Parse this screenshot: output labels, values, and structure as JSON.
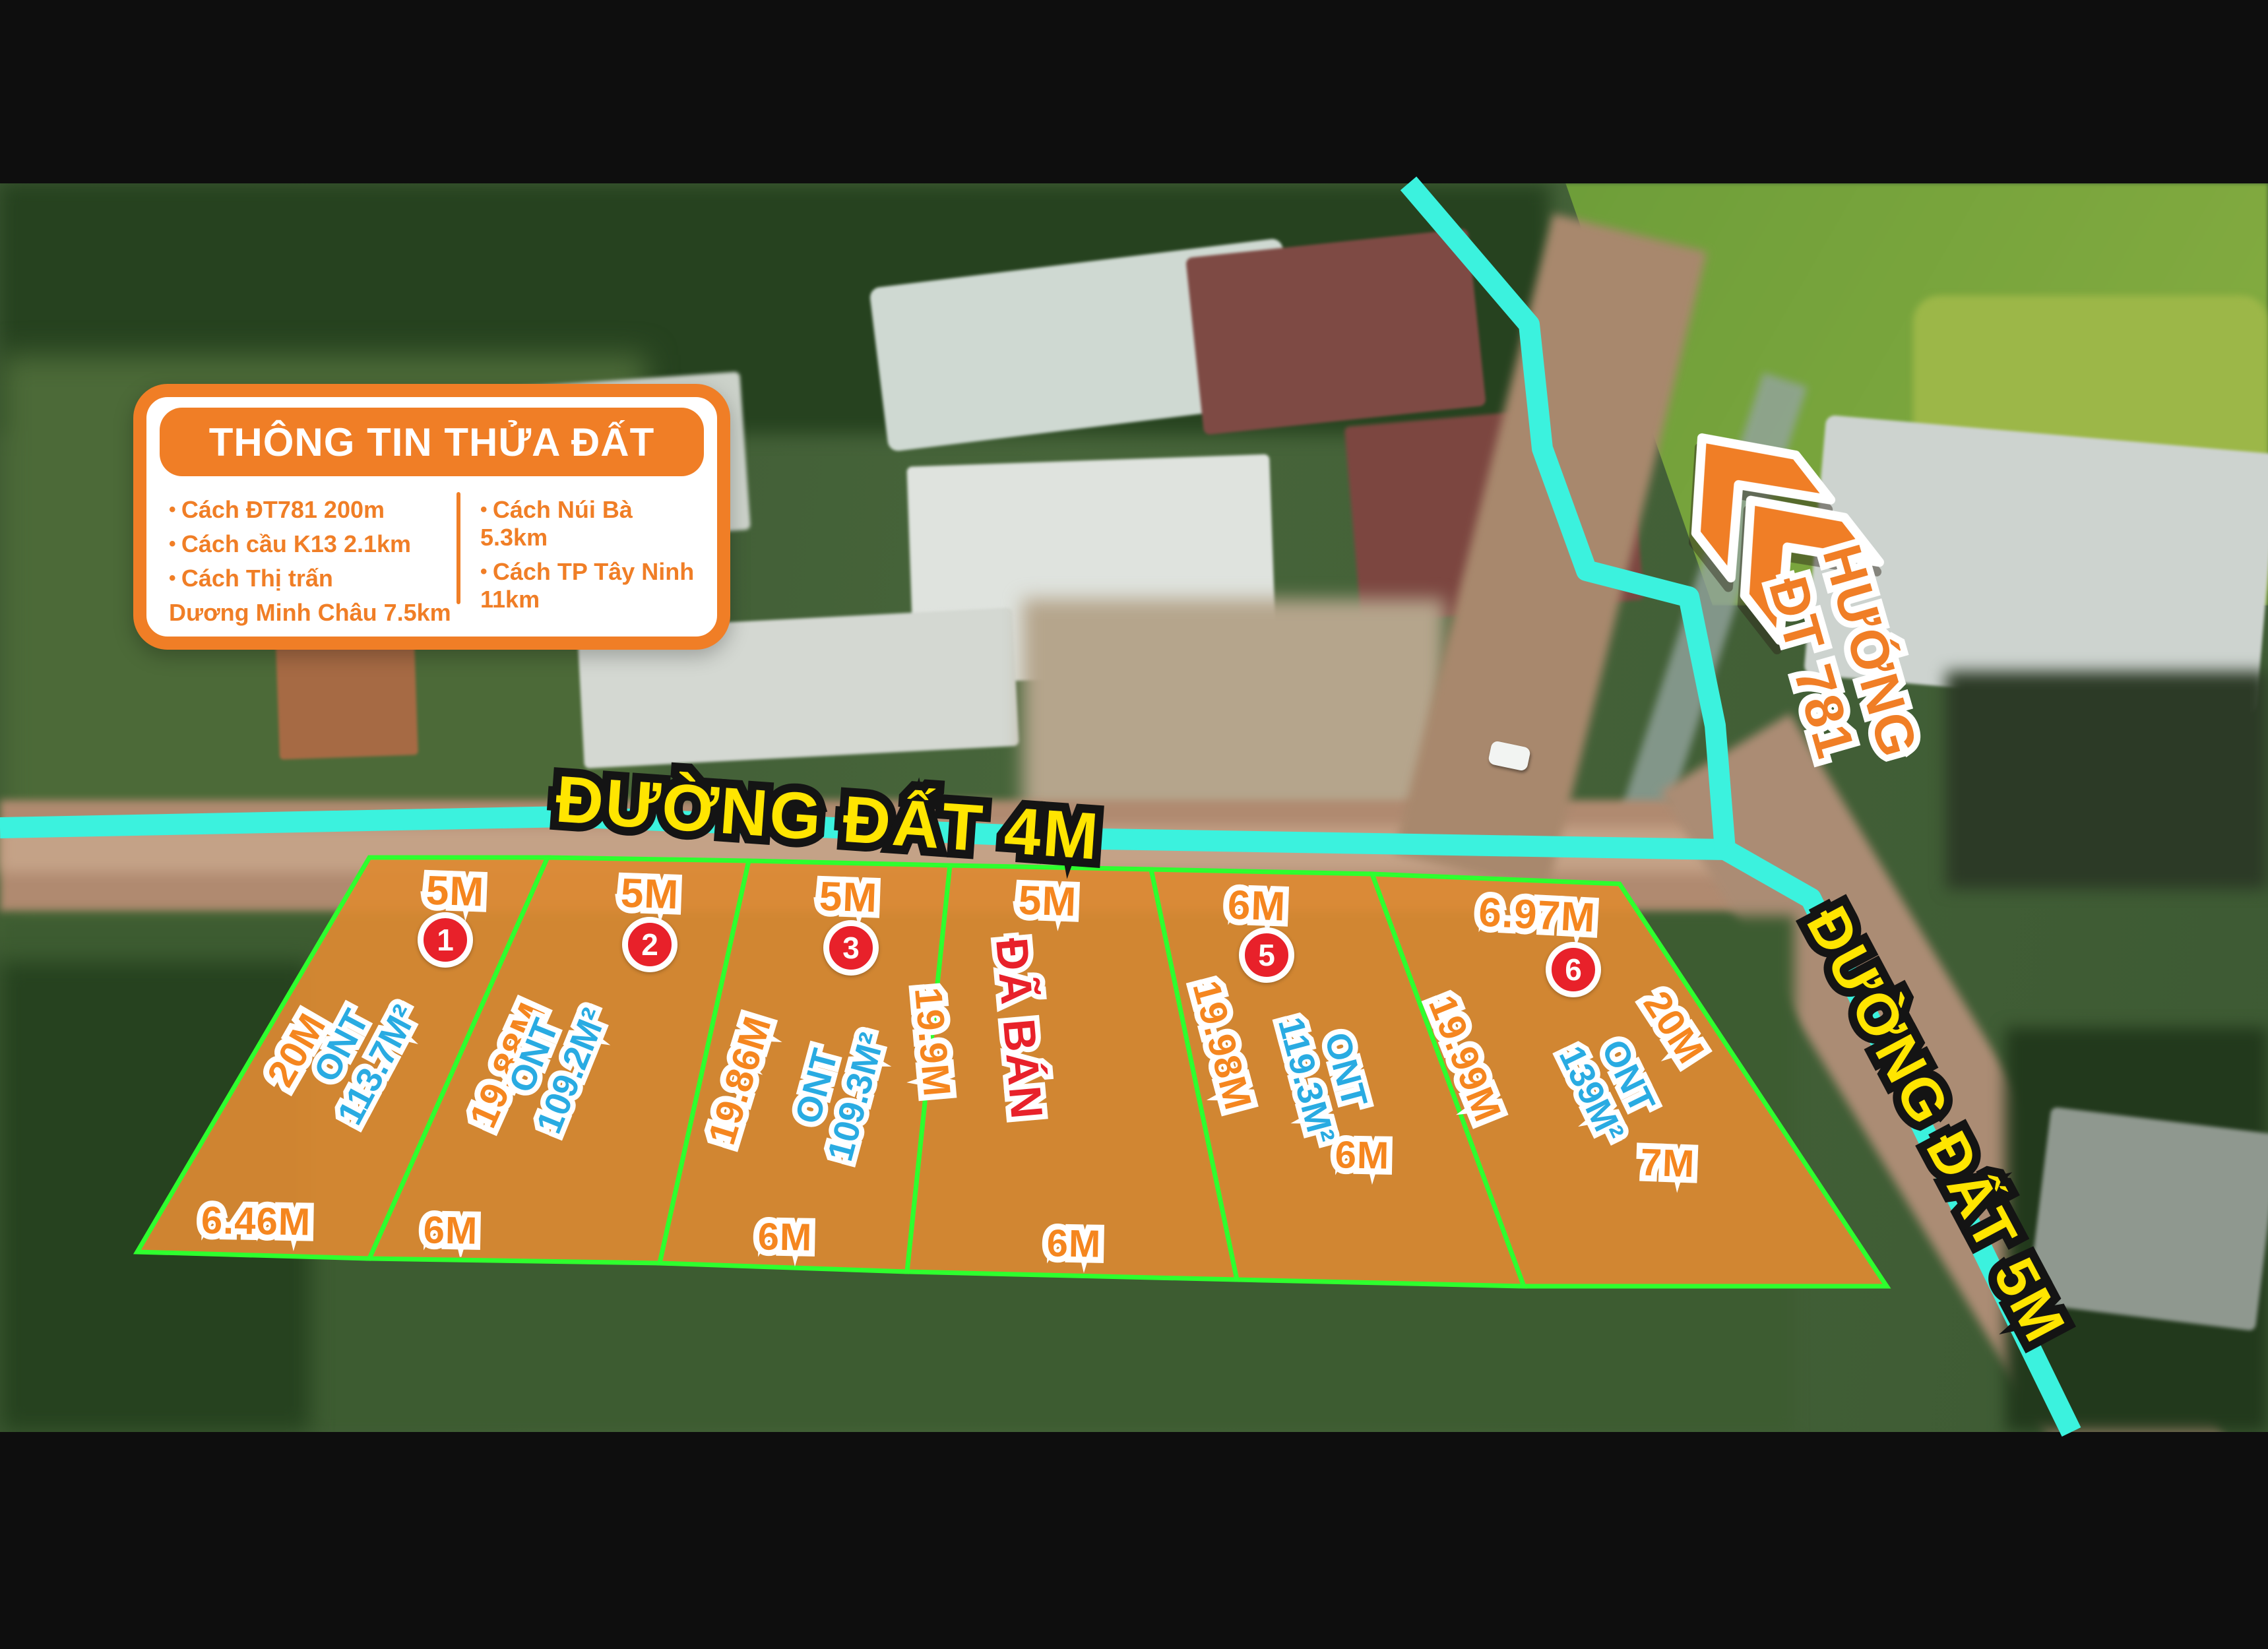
{
  "info_card": {
    "title": "THÔNG TIN THỬA ĐẤT",
    "bullets_left": [
      "Cách ĐT781 200m",
      "Cách cầu K13 2.1km",
      "Cách Thị trấn"
    ],
    "bullets_left_cont": "Dương Minh Châu 7.5km",
    "bullets_right": [
      "Cách Núi Bà 5.3km",
      "Cách TP Tây Ninh 11km"
    ]
  },
  "roads": {
    "top_road_label": "ĐƯỜNG ĐẤT 4M",
    "right_road_label": "ĐƯỜNG ĐẤT 5M",
    "direction_line1": "HƯỚNG",
    "direction_line2": "ĐT 781"
  },
  "plots": [
    {
      "number": "1",
      "top": "5M",
      "bottom": "6.46M",
      "side": "20M",
      "zoning": "ONT",
      "area": "113.7M²",
      "sold": false
    },
    {
      "number": "2",
      "top": "5M",
      "bottom": "6M",
      "side": "19.88M",
      "zoning": "ONT",
      "area": "109.2M²",
      "sold": false
    },
    {
      "number": "3",
      "top": "5M",
      "bottom": "6M",
      "side": "19.86M",
      "zoning": "ONT",
      "area": "109.3M²",
      "sold": false
    },
    {
      "number": "4",
      "top": "5M",
      "bottom": "6M",
      "side": "19.9M",
      "sold_label": "ĐÃ BÁN",
      "sold": true
    },
    {
      "number": "5",
      "top": "6M",
      "bottom": "6M",
      "side": "19.98M",
      "zoning": "ONT",
      "area": "119.3M²",
      "sold": false
    },
    {
      "number": "6",
      "top": "6.97M",
      "bottom": "7M",
      "side": "19.99M",
      "side_right": "20M",
      "zoning": "ONT",
      "area": "139M²",
      "sold": false
    }
  ],
  "colors": {
    "brand_orange": "#F07E26",
    "label_orange": "#F5861F",
    "label_blue": "#29ABE2",
    "sold_red": "#E8212A",
    "plot_border_green": "#2EFF2E",
    "plot_fill_orange": "#DD8A33",
    "road_cyan": "#3BF2DE",
    "road_label_yellow": "#FFE500"
  }
}
